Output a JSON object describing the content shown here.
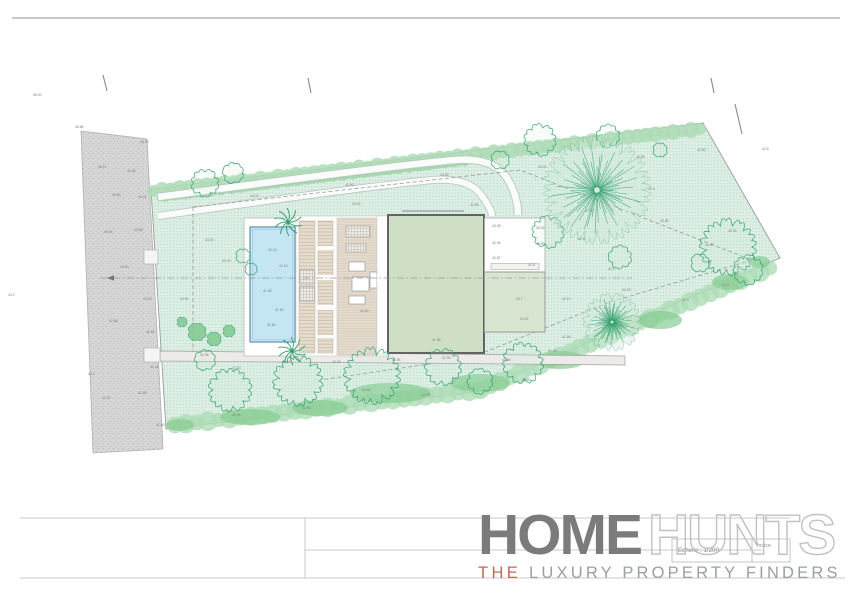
{
  "sheet": {
    "scale_label": "Echelle : 1/200",
    "indice_label": "Indice"
  },
  "logo": {
    "part1": "HOME",
    "part2": "HUNTS",
    "tagline_the": "THE",
    "tagline_rest": "LUXURY PROPERTY FINDERS",
    "accent_color": "#c4675b",
    "dark_gray": "#7b7b7b",
    "outline_gray": "#c2c2c2",
    "tagline_gray": "#9aa0a2"
  },
  "plan": {
    "colors": {
      "plot_fill": "#ddeee5",
      "plot_dot": "#aad5be",
      "hedge": "#aedcb6",
      "hedge_dark": "#86cc92",
      "tree_stroke": "#2f9e6b",
      "pool_fill": "#c3e5f4",
      "pool_stroke": "#5d93ad",
      "building_fill": "#cfdfc5",
      "building_stroke": "#636363",
      "annex_fill": "#d8e6d1",
      "court_fill": "#fefefe",
      "deck_fill": "#e6ddcf",
      "deck_line": "#c6bba8",
      "road_fill": "#d6d6d6",
      "road_dot": "#b3b3b3",
      "band_fill": "#ecebe9",
      "boundary": "#9c9c9c",
      "label_color": "#7d7d7d",
      "line_gray": "#b9b9b9"
    },
    "ticks": [
      {
        "x1": 103,
        "y1": 75,
        "x2": 107,
        "y2": 91
      },
      {
        "x1": 308,
        "y1": 78,
        "x2": 311,
        "y2": 93
      },
      {
        "x1": 711,
        "y1": 78,
        "x2": 714,
        "y2": 93
      },
      {
        "x1": 735,
        "y1": 104,
        "x2": 742,
        "y2": 134
      }
    ],
    "spot_labels": [
      {
        "x": 98,
        "y": 168,
        "v": "45.10"
      },
      {
        "x": 127,
        "y": 172,
        "v": "44.95"
      },
      {
        "x": 140,
        "y": 143,
        "v": "45.30"
      },
      {
        "x": 112,
        "y": 196,
        "v": "44.60"
      },
      {
        "x": 138,
        "y": 198,
        "v": "44.42"
      },
      {
        "x": 104,
        "y": 233,
        "v": "44.05"
      },
      {
        "x": 134,
        "y": 231,
        "v": "43.88"
      },
      {
        "x": 120,
        "y": 268,
        "v": "43.50"
      },
      {
        "x": 143,
        "y": 300,
        "v": "43.05"
      },
      {
        "x": 109,
        "y": 322,
        "v": "42.88"
      },
      {
        "x": 146,
        "y": 333,
        "v": "42.60"
      },
      {
        "x": 102,
        "y": 399,
        "v": "42.02"
      },
      {
        "x": 138,
        "y": 394,
        "v": "41.95"
      },
      {
        "x": 150,
        "y": 368,
        "v": "42.18"
      },
      {
        "x": 156,
        "y": 426,
        "v": "41.60"
      },
      {
        "x": 75,
        "y": 128,
        "v": "45.86"
      },
      {
        "x": 33,
        "y": 96,
        "v": "46.20"
      },
      {
        "x": 8,
        "y": 296,
        "v": "43.2"
      },
      {
        "x": 88,
        "y": 375,
        "v": "42.1"
      },
      {
        "x": 250,
        "y": 197,
        "v": "44.20"
      },
      {
        "x": 345,
        "y": 186,
        "v": "43.90"
      },
      {
        "x": 440,
        "y": 176,
        "v": "43.55"
      },
      {
        "x": 538,
        "y": 168,
        "v": "43.20"
      },
      {
        "x": 636,
        "y": 158,
        "v": "42.95"
      },
      {
        "x": 697,
        "y": 151,
        "v": "42.80"
      },
      {
        "x": 762,
        "y": 150,
        "v": "42.6"
      },
      {
        "x": 205,
        "y": 241,
        "v": "43.40"
      },
      {
        "x": 222,
        "y": 262,
        "v": "43.15"
      },
      {
        "x": 352,
        "y": 205,
        "v": "43.30"
      },
      {
        "x": 470,
        "y": 206,
        "v": "42.95"
      },
      {
        "x": 585,
        "y": 212,
        "v": "42.70"
      },
      {
        "x": 660,
        "y": 222,
        "v": "42.55"
      },
      {
        "x": 705,
        "y": 246,
        "v": "42.40"
      },
      {
        "x": 728,
        "y": 232,
        "v": "42.35"
      },
      {
        "x": 180,
        "y": 300,
        "v": "42.90"
      },
      {
        "x": 200,
        "y": 356,
        "v": "42.35"
      },
      {
        "x": 232,
        "y": 369,
        "v": "42.20"
      },
      {
        "x": 282,
        "y": 363,
        "v": "42.10"
      },
      {
        "x": 332,
        "y": 363,
        "v": "42.05"
      },
      {
        "x": 392,
        "y": 361,
        "v": "41.95"
      },
      {
        "x": 442,
        "y": 359,
        "v": "41.90"
      },
      {
        "x": 502,
        "y": 361,
        "v": "41.80"
      },
      {
        "x": 548,
        "y": 352,
        "v": "41.75"
      },
      {
        "x": 432,
        "y": 341,
        "v": "41.98"
      },
      {
        "x": 520,
        "y": 320,
        "v": "42.02"
      },
      {
        "x": 562,
        "y": 300,
        "v": "42.10"
      },
      {
        "x": 622,
        "y": 291,
        "v": "42.15"
      },
      {
        "x": 682,
        "y": 301,
        "v": "41.9"
      },
      {
        "x": 722,
        "y": 286,
        "v": "41.8"
      },
      {
        "x": 362,
        "y": 391,
        "v": "41.60"
      },
      {
        "x": 422,
        "y": 396,
        "v": "41.55"
      },
      {
        "x": 302,
        "y": 409,
        "v": "41.50"
      },
      {
        "x": 232,
        "y": 416,
        "v": "41.45"
      },
      {
        "x": 522,
        "y": 381,
        "v": "41.40"
      },
      {
        "x": 562,
        "y": 338,
        "v": "41.85"
      },
      {
        "x": 608,
        "y": 270,
        "v": "42.3"
      },
      {
        "x": 648,
        "y": 190,
        "v": "42.6"
      },
      {
        "x": 578,
        "y": 240,
        "v": "42.5"
      },
      {
        "x": 268,
        "y": 251,
        "v": "42.15"
      },
      {
        "x": 279,
        "y": 267,
        "v": "42.10"
      },
      {
        "x": 263,
        "y": 292,
        "v": "41.95"
      },
      {
        "x": 275,
        "y": 311,
        "v": "41.90"
      },
      {
        "x": 267,
        "y": 326,
        "v": "41.85"
      },
      {
        "x": 492,
        "y": 227,
        "v": "43.08"
      },
      {
        "x": 536,
        "y": 229,
        "v": "43.02"
      },
      {
        "x": 492,
        "y": 244,
        "v": "42.96"
      },
      {
        "x": 536,
        "y": 245,
        "v": "42.90"
      },
      {
        "x": 492,
        "y": 259,
        "v": "42.87"
      },
      {
        "x": 528,
        "y": 266,
        "v": "42.8"
      },
      {
        "x": 516,
        "y": 300,
        "v": "42.7"
      },
      {
        "x": 360,
        "y": 312,
        "v": "42.60"
      }
    ],
    "trees": {
      "clouds": [
        {
          "x": 205,
          "y": 183,
          "r": 13
        },
        {
          "x": 233,
          "y": 173,
          "r": 10
        },
        {
          "x": 540,
          "y": 140,
          "r": 15
        },
        {
          "x": 608,
          "y": 136,
          "r": 11
        },
        {
          "x": 500,
          "y": 160,
          "r": 9
        },
        {
          "x": 548,
          "y": 232,
          "r": 15
        },
        {
          "x": 620,
          "y": 257,
          "r": 11
        },
        {
          "x": 728,
          "y": 247,
          "r": 26
        },
        {
          "x": 748,
          "y": 270,
          "r": 14
        },
        {
          "x": 700,
          "y": 263,
          "r": 9
        },
        {
          "x": 660,
          "y": 150,
          "r": 7
        },
        {
          "x": 230,
          "y": 390,
          "r": 20
        },
        {
          "x": 298,
          "y": 381,
          "r": 23
        },
        {
          "x": 372,
          "y": 376,
          "r": 26
        },
        {
          "x": 443,
          "y": 367,
          "r": 17
        },
        {
          "x": 523,
          "y": 363,
          "r": 19
        },
        {
          "x": 480,
          "y": 381,
          "r": 12
        },
        {
          "x": 243,
          "y": 256,
          "r": 7
        },
        {
          "x": 251,
          "y": 269,
          "r": 6
        },
        {
          "x": 205,
          "y": 360,
          "r": 10
        }
      ],
      "starbursts": [
        {
          "x": 597,
          "y": 190,
          "r": 48
        },
        {
          "x": 612,
          "y": 322,
          "r": 26
        }
      ],
      "palms": [
        {
          "x": 288,
          "y": 222,
          "r": 14
        },
        {
          "x": 292,
          "y": 351,
          "r": 14
        }
      ],
      "bushes": [
        {
          "x": 197,
          "y": 332,
          "r": 9
        },
        {
          "x": 214,
          "y": 339,
          "r": 7
        },
        {
          "x": 229,
          "y": 331,
          "r": 6
        },
        {
          "x": 182,
          "y": 322,
          "r": 5
        }
      ],
      "hedge_blobs": [
        {
          "x": 390,
          "y": 393,
          "rx": 40,
          "ry": 10
        },
        {
          "x": 480,
          "y": 383,
          "rx": 30,
          "ry": 9
        },
        {
          "x": 560,
          "y": 360,
          "rx": 26,
          "ry": 9
        },
        {
          "x": 660,
          "y": 320,
          "rx": 22,
          "ry": 9
        },
        {
          "x": 730,
          "y": 282,
          "rx": 18,
          "ry": 8
        },
        {
          "x": 250,
          "y": 417,
          "rx": 30,
          "ry": 8
        },
        {
          "x": 320,
          "y": 408,
          "rx": 28,
          "ry": 8
        },
        {
          "x": 180,
          "y": 425,
          "rx": 14,
          "ry": 6
        },
        {
          "x": 760,
          "y": 262,
          "rx": 10,
          "ry": 6
        }
      ]
    }
  }
}
